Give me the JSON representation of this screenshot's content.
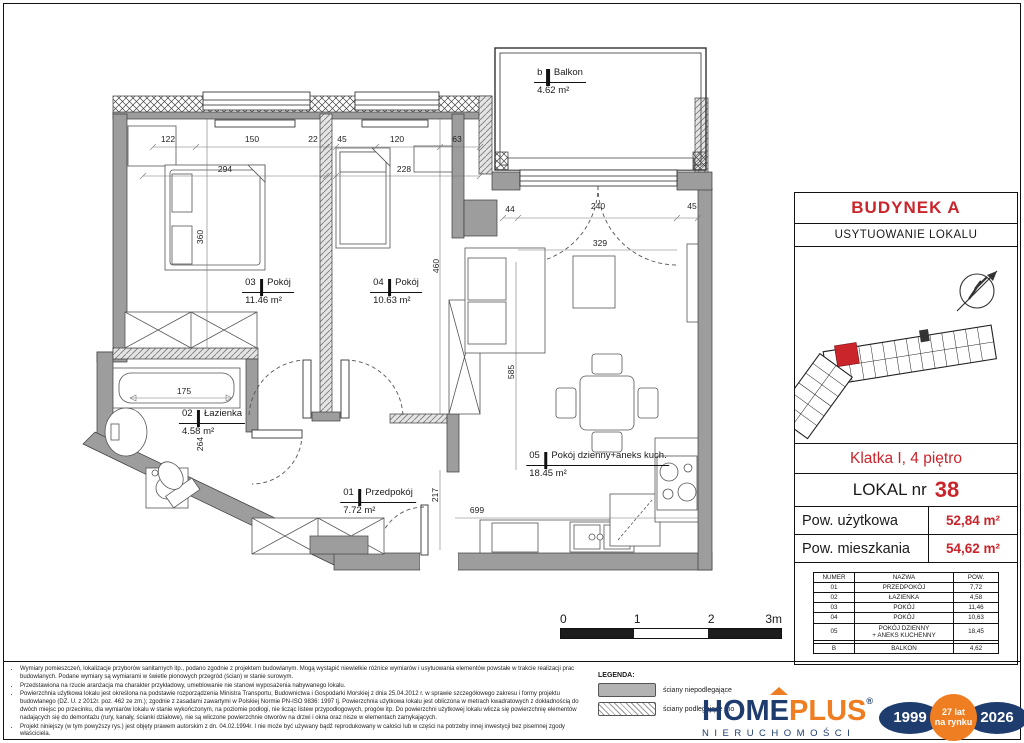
{
  "colors": {
    "accent_red": "#c9252b",
    "navy": "#1e3c6e",
    "orange": "#ef7d21",
    "wall_gray": "#9d9d9d"
  },
  "plan": {
    "rooms": [
      {
        "num": "b",
        "name": "Balkon",
        "area": "4.62 m²",
        "x": 560,
        "y": 64
      },
      {
        "num": "03",
        "name": "Pokój",
        "area": "11.46 m²",
        "x": 268,
        "y": 274
      },
      {
        "num": "04",
        "name": "Pokój",
        "area": "10.63 m²",
        "x": 396,
        "y": 274
      },
      {
        "num": "02",
        "name": "Łazienka",
        "area": "4.58 m²",
        "x": 212,
        "y": 405
      },
      {
        "num": "01",
        "name": "Przedpokój",
        "area": "7.72 m²",
        "x": 378,
        "y": 484
      },
      {
        "num": "05",
        "name": "Pokój dzienny+aneks kuch.",
        "area": "18.45 m²",
        "x": 598,
        "y": 447
      }
    ],
    "dims": [
      {
        "t": "122",
        "x": 168,
        "y": 139
      },
      {
        "t": "150",
        "x": 252,
        "y": 139
      },
      {
        "t": "22",
        "x": 313,
        "y": 139
      },
      {
        "t": "45",
        "x": 342,
        "y": 139
      },
      {
        "t": "120",
        "x": 397,
        "y": 139
      },
      {
        "t": "63",
        "x": 457,
        "y": 139
      },
      {
        "t": "294",
        "x": 225,
        "y": 169
      },
      {
        "t": "228",
        "x": 404,
        "y": 169
      },
      {
        "t": "360",
        "x": 200,
        "y": 237,
        "r": 1
      },
      {
        "t": "460",
        "x": 436,
        "y": 266,
        "r": 1
      },
      {
        "t": "44",
        "x": 510,
        "y": 209
      },
      {
        "t": "240",
        "x": 598,
        "y": 206
      },
      {
        "t": "45",
        "x": 692,
        "y": 206
      },
      {
        "t": "329",
        "x": 600,
        "y": 243
      },
      {
        "t": "585",
        "x": 511,
        "y": 372,
        "r": 1
      },
      {
        "t": "175",
        "x": 184,
        "y": 391
      },
      {
        "t": "264",
        "x": 200,
        "y": 444,
        "r": 1
      },
      {
        "t": "217",
        "x": 435,
        "y": 495,
        "r": 1
      },
      {
        "t": "699",
        "x": 477,
        "y": 510
      }
    ]
  },
  "scalebar": {
    "labels": [
      "0",
      "1",
      "2",
      "3m"
    ]
  },
  "panel": {
    "building": "BUDYNEK A",
    "location_title": "USYTUOWANIE LOKALU",
    "staircase": "Klatka I, 4 piętro",
    "lokal_label": "LOKAL nr",
    "lokal_number": "38",
    "area_usable_label": "Pow. użytkowa",
    "area_usable_value": "52,84 m²",
    "area_resident_label": "Pow. mieszkania",
    "area_resident_value": "54,62 m²",
    "table": {
      "headers": [
        "NUMER",
        "NAZWA",
        "POW."
      ],
      "rows": [
        [
          "01",
          "PRZEDPOKÓJ",
          "7,72"
        ],
        [
          "02",
          "ŁAZIENKA",
          "4,58"
        ],
        [
          "03",
          "POKÓJ",
          "11,46"
        ],
        [
          "04",
          "POKÓJ",
          "10,63"
        ],
        [
          "05",
          "POKÓJ DZIENNY\n+ ANEKS KUCHENNY",
          "18,45"
        ],
        [
          "",
          "",
          ""
        ],
        [
          "B",
          "BALKON",
          "4,62"
        ]
      ]
    }
  },
  "legend": {
    "title": "LEGENDA:",
    "items": [
      {
        "label": "ściany niepodlegające",
        "swatch": "solid"
      },
      {
        "label": "ściany podlegające mo",
        "swatch": "hatch"
      }
    ]
  },
  "disclaimer": {
    "bullets": [
      "Wymiary pomieszczeń, lokalizacje przyborów sanitarnych itp., podano zgodnie z projektem budowlanym. Mogą wystąpić niewielkie różnice wymiarów i usytuowania elementów powstałe w trakcie realizacji prac budowlanych. Podane wymiary są wymiarami w świetle pionowych przegród (ścian) w stanie surowym.",
      "Przedstawiona na rzucie aranżacja ma charakter przykładowy, umeblowanie nie stanowi wyposażenia nabywanego lokalu.",
      "Powierzchnia użytkowa lokalu jest określona na podstawie rozporządzenia Ministra Transportu, Budownictwa i Gospodarki Morskiej z dnia 25.04.2012 r. w sprawie szczegółowego zakresu i formy projektu budowlanego (DZ. U. z 2012r. poz. 462 ze zm.); zgodnie z zasadami zawartymi w Polskiej Normie PN-ISO 9836: 1997 tj. Powierzchnia użytkowa lokalu jest obliczona w metrach kwadratowych z dokładnością do dwóch miejsc po przecinku, dla wymiarów lokalu w stanie wykończonym, na poziomie podłogi, nie licząc listew przypodłogowych, progów itp. Do powierzchni użytkowej lokalu wlicza się powierzchnię elementów nadających się do demontażu (rury, kanały, ścianki działowe), nie są wliczone powierzchnie otworów na drzwi i okna oraz nisze w elementach zamykających.",
      "Projekt niniejszy (w tym powyższy rys.) jest objęty prawem autorskim z dn. 04.02.1994r. I nie może być używany bądź reprodukowany w całości lub w części na potrzeby innej inwestycji bez pisemnej zgody właściciela."
    ]
  },
  "logo": {
    "hom": "HOM",
    "e": "E",
    "plus": "PLUS",
    "reg": "®",
    "sub": "NIERUCHOMOŚCI",
    "year_start": "1999",
    "badge_line1": "27 lat",
    "badge_line2": "na rynku",
    "year_end": "2026"
  }
}
